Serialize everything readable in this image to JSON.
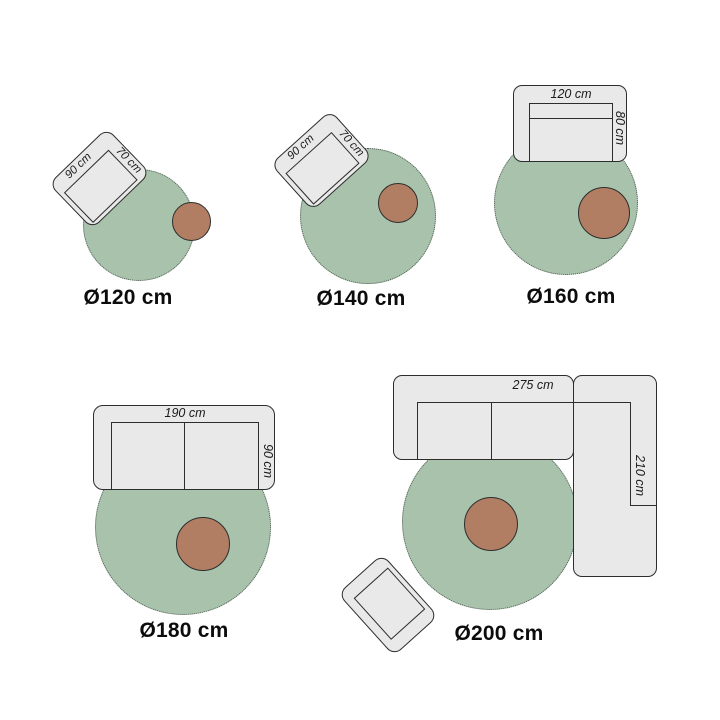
{
  "page": {
    "background": "#ffffff",
    "description": "Round rug size guide showing furniture arrangements on five rug diameters"
  },
  "colors": {
    "background": "#ffffff",
    "rug_green": "#a8c2ac",
    "table_brown": "#b17e63",
    "furniture_grey": "#e9e9e9",
    "outline": "#2d2d2d",
    "label_text": "#1a1a1a",
    "caption_text": "#0c0c0c"
  },
  "groups": [
    {
      "caption": "Ø120 cm",
      "furniture": "armchair-and-side-table",
      "dims": {
        "width": "90 cm",
        "depth": "70 cm"
      }
    },
    {
      "caption": "Ø140 cm",
      "furniture": "armchair-and-side-table",
      "dims": {
        "width": "90 cm",
        "depth": "70 cm"
      }
    },
    {
      "caption": "Ø160 cm",
      "furniture": "small-sofa-and-side-table",
      "dims": {
        "width": "120 cm",
        "depth": "80 cm"
      }
    },
    {
      "caption": "Ø180 cm",
      "furniture": "two-seat-sofa-and-side-table",
      "dims": {
        "width": "190 cm",
        "depth": "90 cm"
      }
    },
    {
      "caption": "Ø200 cm",
      "furniture": "corner-sofa-side-table-and-ottoman",
      "dims": {
        "width": "275 cm",
        "depth": "210 cm"
      }
    }
  ]
}
